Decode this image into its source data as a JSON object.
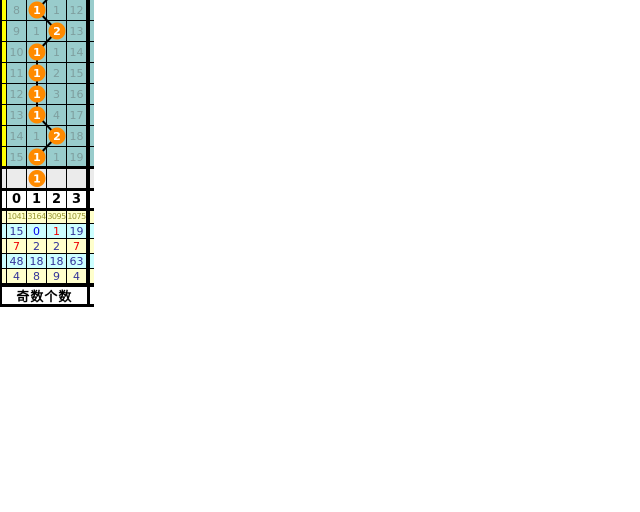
{
  "colors": {
    "page_bg": "#FFFFFF",
    "teal_bg": "#99CCCC",
    "teal_text": "#7E9E9E",
    "grid_line": "#000000",
    "ball_fill": "#FF8A00",
    "ball_text": "#FFFFFF",
    "predict_bg": "#EBEBEB",
    "header_bg": "#FFFFFF",
    "header_text": "#000000",
    "stats_yellow_bg": "#FFFFCC",
    "stats_cyan_bg": "#CCFFFF",
    "stats_olive_text": "#999933",
    "stats_navy_text": "#333399",
    "stats_blue_text": "#0000EE",
    "stats_red_text": "#EE0000",
    "left_strip_yellow": "#FFFF00",
    "title_bg": "#FFFFFF",
    "title_text": "#000000"
  },
  "chart_data": {
    "type": "table",
    "section_title": "奇数个数",
    "columns": [
      "0",
      "1",
      "2",
      "3"
    ],
    "trend_rows": [
      {
        "miss": [
          "8",
          null,
          "1",
          "12"
        ],
        "hit_col": 1,
        "hit_value": "1"
      },
      {
        "miss": [
          "9",
          "1",
          null,
          "13"
        ],
        "hit_col": 2,
        "hit_value": "2"
      },
      {
        "miss": [
          "10",
          null,
          "1",
          "14"
        ],
        "hit_col": 1,
        "hit_value": "1"
      },
      {
        "miss": [
          "11",
          null,
          "2",
          "15"
        ],
        "hit_col": 1,
        "hit_value": "1"
      },
      {
        "miss": [
          "12",
          null,
          "3",
          "16"
        ],
        "hit_col": 1,
        "hit_value": "1"
      },
      {
        "miss": [
          "13",
          null,
          "4",
          "17"
        ],
        "hit_col": 1,
        "hit_value": "1"
      },
      {
        "miss": [
          "14",
          "1",
          null,
          "18"
        ],
        "hit_col": 2,
        "hit_value": "2"
      },
      {
        "miss": [
          "15",
          null,
          "1",
          "19"
        ],
        "hit_col": 1,
        "hit_value": "1"
      }
    ],
    "prediction_row": {
      "hit_col": 1,
      "hit_value": "1"
    },
    "stats_rows": [
      {
        "values": [
          "1041",
          "3164",
          "3095",
          "1075"
        ],
        "bg": "yellow",
        "colors": [
          "olive",
          "olive",
          "olive",
          "olive"
        ]
      },
      {
        "values": [
          "15",
          "0",
          "1",
          "19"
        ],
        "bg": "cyan",
        "colors": [
          "navy",
          "blue",
          "red",
          "navy"
        ]
      },
      {
        "values": [
          "7",
          "2",
          "2",
          "7"
        ],
        "bg": "yellow",
        "colors": [
          "red",
          "navy",
          "navy",
          "red"
        ]
      },
      {
        "values": [
          "48",
          "18",
          "18",
          "63"
        ],
        "bg": "cyan",
        "colors": [
          "navy",
          "navy",
          "navy",
          "navy"
        ]
      },
      {
        "values": [
          "4",
          "8",
          "9",
          "4"
        ],
        "bg": "yellow",
        "colors": [
          "navy",
          "navy",
          "navy",
          "navy"
        ]
      }
    ]
  }
}
